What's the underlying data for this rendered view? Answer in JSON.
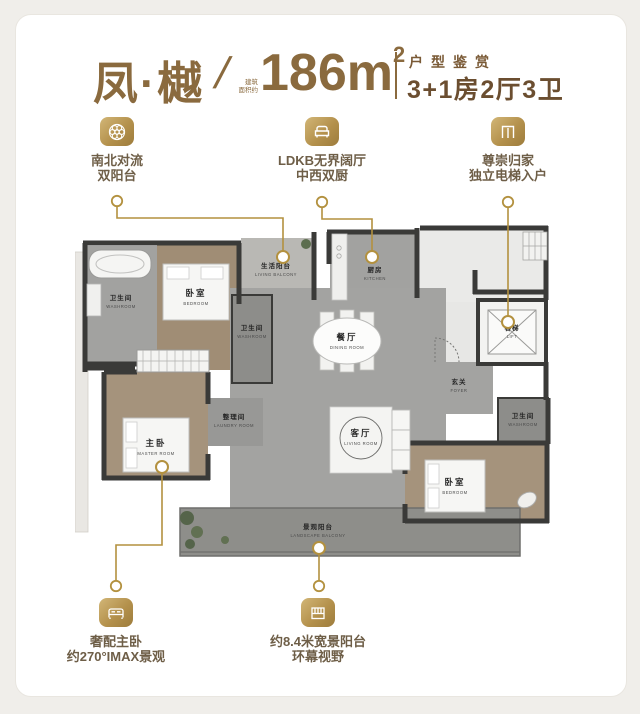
{
  "header": {
    "name": "凤·樾",
    "slash": "/",
    "area_note1": "建筑",
    "area_note2": "面积约",
    "area_value": "186m",
    "area_superscript": "2",
    "series_label": "户型鉴赏",
    "layout_spec": "3+1房2厅3卫"
  },
  "features": {
    "top": [
      {
        "icon": "rosette-icon",
        "line1": "南北对流",
        "line2": "双阳台"
      },
      {
        "icon": "sofa-icon",
        "line1": "LDKB无界阔厅",
        "line2": "中西双厨"
      },
      {
        "icon": "elevator-doors-icon",
        "line1": "尊崇归家",
        "line2": "独立电梯入户"
      }
    ],
    "bottom": [
      {
        "icon": "bed-icon",
        "line1": "奢配主卧",
        "line2": "约270°IMAX景观"
      },
      {
        "icon": "balcony-window-icon",
        "line1": "约8.4米宽景阳台",
        "line2": "环幕视野"
      }
    ]
  },
  "plan": {
    "rooms": {
      "bath1_cn": "卫生间",
      "bath1_en": "WASHROOM",
      "bedroom1_cn": "卧室",
      "bedroom1_en": "BEDROOM",
      "living_balcony_cn": "生活阳台",
      "living_balcony_en": "LIVING BALCONY",
      "kitchen_cn": "厨房",
      "kitchen_en": "KITCHEN",
      "lift_cn": "客梯",
      "lift_en": "LIFT",
      "bath2_cn": "卫生间",
      "bath2_en": "WASHROOM",
      "dining_cn": "餐厅",
      "dining_en": "DINING ROOM",
      "foyer_cn": "玄关",
      "foyer_en": "FOYER",
      "laundry_cn": "整理间",
      "laundry_en": "LAUNDRY ROOM",
      "master_cn": "主卧",
      "master_en": "MASTER ROOM",
      "living_cn": "客厅",
      "living_en": "LIVING ROOM",
      "bedroom2_cn": "卧室",
      "bedroom2_en": "BEDROOM",
      "bath3_cn": "卫生间",
      "bath3_en": "WASHROOM",
      "balcony_cn": "景观阳台",
      "balcony_en": "LANDSCAPE BALCONY"
    }
  },
  "colors": {
    "accent_gold": "#b3913f",
    "title_brown": "#8a6a3e",
    "spec_brown": "#6b4e30",
    "wall_dark": "#3a3a38",
    "wood_floor": "#a5937c",
    "marble_gray": "#a3a3a1"
  }
}
